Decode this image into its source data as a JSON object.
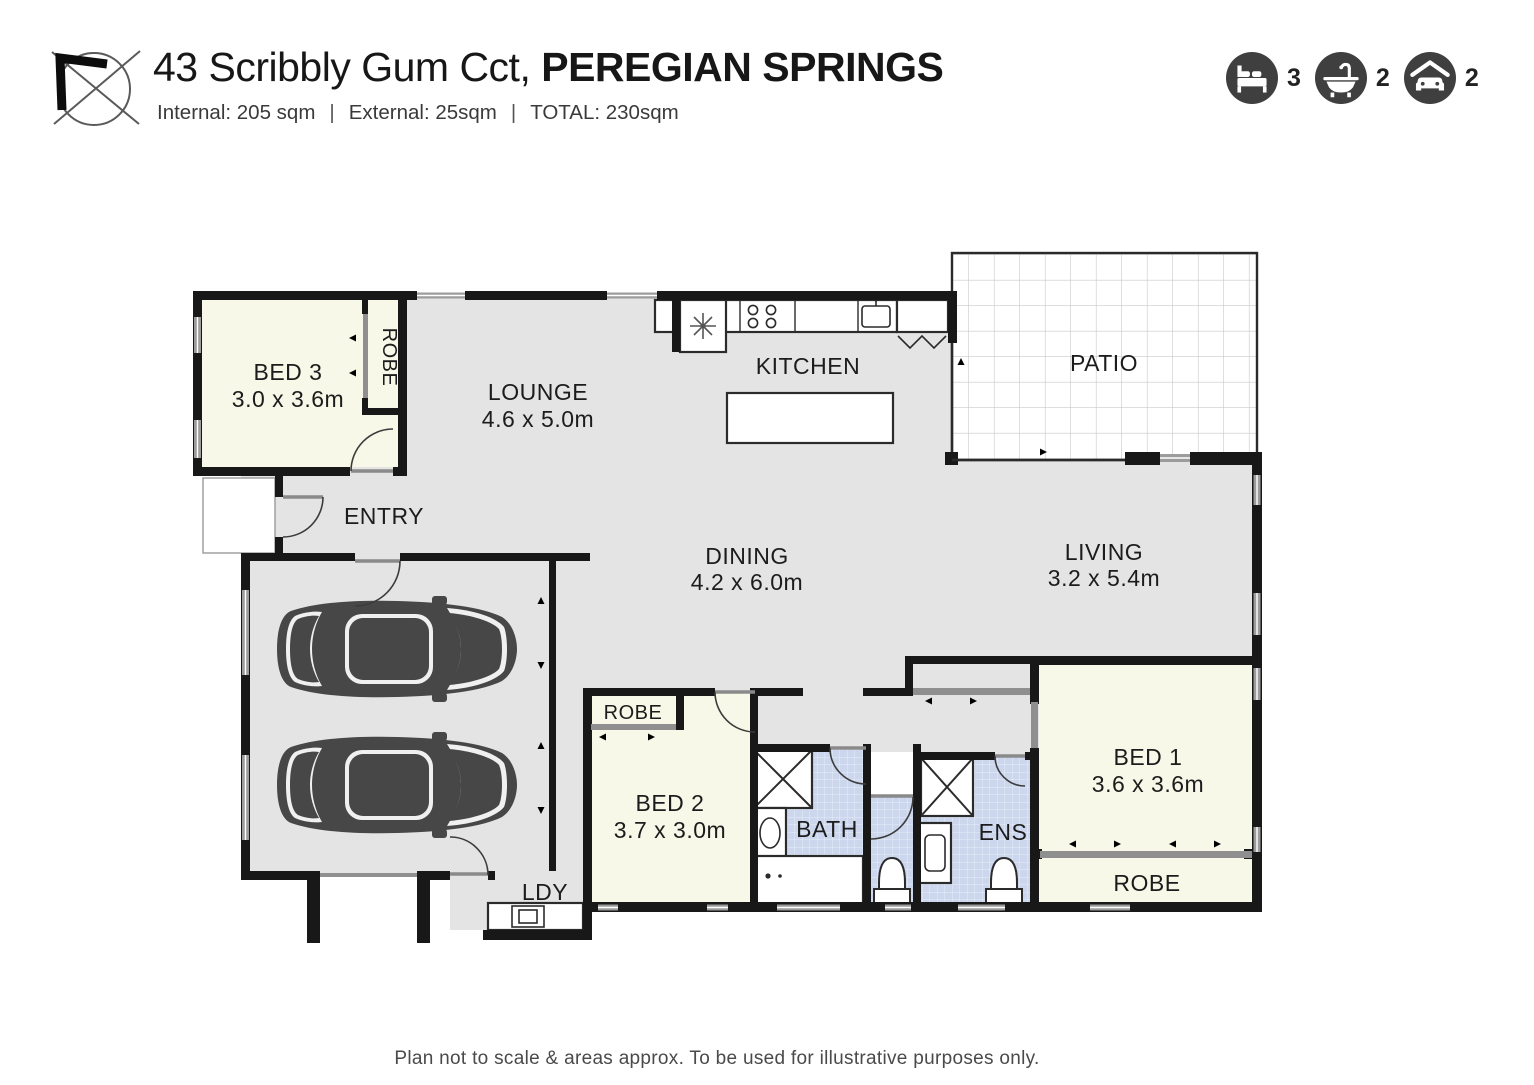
{
  "header": {
    "address_normal": "43 Scribbly Gum Cct, ",
    "address_bold": "PEREGIAN SPRINGS",
    "area_internal": "Internal: 205 sqm",
    "area_external": "External: 25sqm",
    "area_total": "TOTAL: 230sqm",
    "separator": "|",
    "stats": {
      "beds": "3",
      "baths": "2",
      "cars": "2"
    }
  },
  "plan": {
    "rooms": {
      "bed3": {
        "name": "BED 3",
        "dims": "3.0 x 3.6m"
      },
      "robe3": {
        "name": "ROBE"
      },
      "lounge": {
        "name": "LOUNGE",
        "dims": "4.6 x 5.0m"
      },
      "kitchen": {
        "name": "KITCHEN"
      },
      "patio": {
        "name": "PATIO"
      },
      "entry": {
        "name": "ENTRY"
      },
      "dining": {
        "name": "DINING",
        "dims": "4.2 x 6.0m"
      },
      "living": {
        "name": "LIVING",
        "dims": "3.2 x 5.4m"
      },
      "ldy": {
        "name": "LDY"
      },
      "robe2": {
        "name": "ROBE"
      },
      "bed2": {
        "name": "BED 2",
        "dims": "3.7 x 3.0m"
      },
      "bath": {
        "name": "BATH"
      },
      "ens": {
        "name": "ENS"
      },
      "bed1": {
        "name": "BED 1",
        "dims": "3.6 x 3.6m"
      },
      "robe1": {
        "name": "ROBE"
      }
    }
  },
  "footer": {
    "disclaimer": "Plan not to scale & areas approx. To be used for illustrative purposes only."
  },
  "colors": {
    "wall": "#181818",
    "floor_main": "#e4e4e4",
    "floor_bedroom": "#f8f8e8",
    "floor_wet_area": "#ccd7ee",
    "icon_circle": "#3f3f3f",
    "car": "#474747"
  }
}
